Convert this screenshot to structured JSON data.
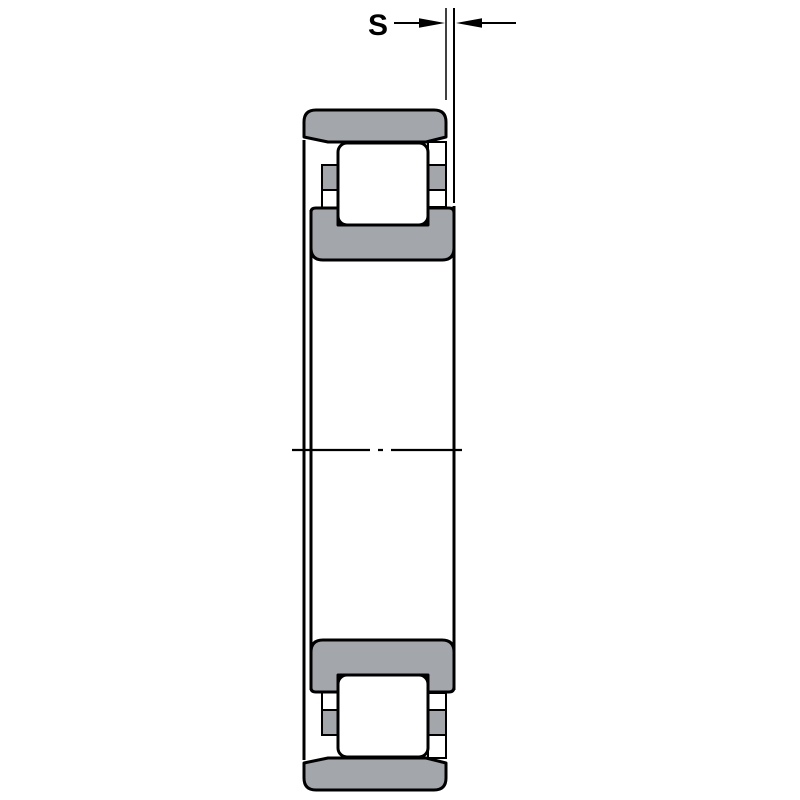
{
  "drawing": {
    "type": "bearing-cross-section",
    "subject": "cylindrical-roller-bearing-N-design",
    "dimension": {
      "label": "S"
    },
    "colors": {
      "background": "#ffffff",
      "ring_fill": "#a3a6aa",
      "cage_fill": "#a3a6aa",
      "roller_fill": "#ffffff",
      "line": "#000000"
    }
  }
}
